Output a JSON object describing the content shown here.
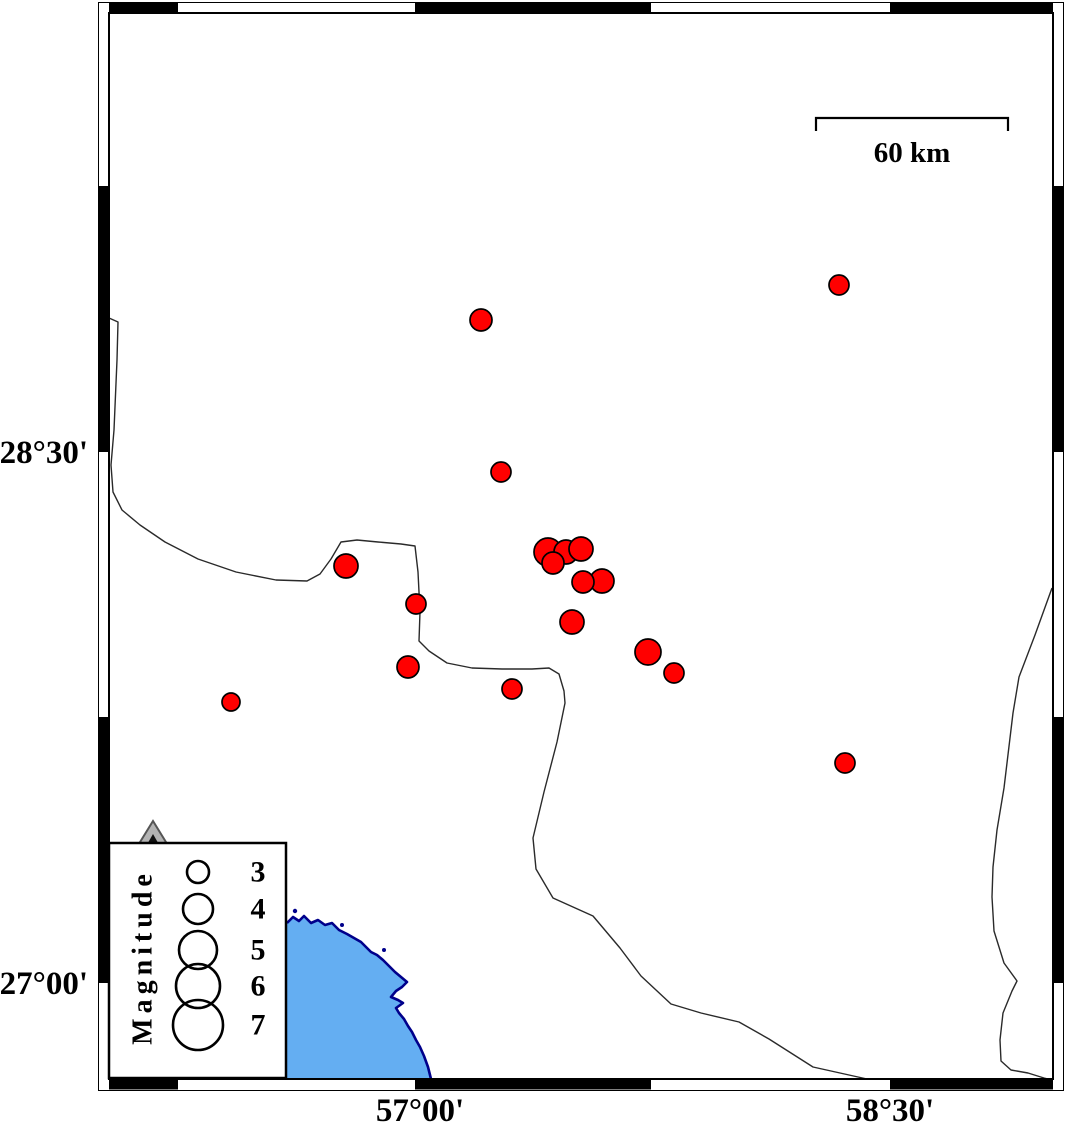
{
  "map": {
    "colors": {
      "epicenter": "#ff0000",
      "epicenter_outline": "#000000",
      "sea": "#64aef2",
      "coastline": "#00008b",
      "boundary": "#2a2a2a",
      "frame": "#000000",
      "land": "#ffffff",
      "legend_triangle": "#b3b3b3"
    },
    "frame": {
      "lat_labels": [
        {
          "text": "28°30'",
          "y": 452
        },
        {
          "text": "27°00'",
          "y": 983
        }
      ],
      "lon_labels": [
        {
          "text": "57°00'",
          "x": 420
        },
        {
          "text": "58°30'",
          "x": 890
        }
      ]
    },
    "scale_bar": {
      "label": "60 km"
    },
    "legend": {
      "title": "Magnitude",
      "entries": [
        {
          "label": "3",
          "r": 11,
          "cy": 872
        },
        {
          "label": "4",
          "r": 15,
          "cy": 909
        },
        {
          "label": "5",
          "r": 19,
          "cy": 950
        },
        {
          "label": "6",
          "r": 22,
          "cy": 986
        },
        {
          "label": "7",
          "r": 25,
          "cy": 1025
        }
      ]
    },
    "earthquakes": [
      {
        "x": 481,
        "y": 320,
        "r": 11
      },
      {
        "x": 839,
        "y": 285,
        "r": 10
      },
      {
        "x": 501,
        "y": 472,
        "r": 10
      },
      {
        "x": 548,
        "y": 552,
        "r": 14
      },
      {
        "x": 566,
        "y": 552,
        "r": 12
      },
      {
        "x": 581,
        "y": 549,
        "r": 12
      },
      {
        "x": 553,
        "y": 563,
        "r": 11
      },
      {
        "x": 602,
        "y": 581,
        "r": 12
      },
      {
        "x": 583,
        "y": 582,
        "r": 11
      },
      {
        "x": 572,
        "y": 622,
        "r": 12
      },
      {
        "x": 346,
        "y": 566,
        "r": 12
      },
      {
        "x": 416,
        "y": 604,
        "r": 10
      },
      {
        "x": 408,
        "y": 667,
        "r": 11
      },
      {
        "x": 648,
        "y": 652,
        "r": 13
      },
      {
        "x": 674,
        "y": 673,
        "r": 10
      },
      {
        "x": 231,
        "y": 702,
        "r": 9
      },
      {
        "x": 512,
        "y": 689,
        "r": 10
      },
      {
        "x": 845,
        "y": 763,
        "r": 10
      }
    ],
    "paths": {
      "boundary_north": "M109,318 L118,322 L117,360 L114,430 L111,465 L113,492 L122,510 L140,525 L165,542 L198,559 L236,572 L276,580 L307,581 L320,574 L331,559 L341,542 L357,540 L378,542 L401,544 L415,546 L418,572 L420,612 L419,641 L429,651 L447,663 L472,668 L502,669 L532,669 L549,668 L559,674 L564,691 L565,703 L557,742 L544,792 L533,838 L536,869 L553,898 L593,916 L620,948 L641,976 L671,1004 L701,1013 L739,1022 L769,1039 L813,1067 L867,1079",
      "boundary_east": "M1052,588 L1035,635 L1019,677 L1013,713 L1004,788 L997,830 L993,867 L992,897 L994,931 L1004,963 L1017,981 L1012,991 L1003,1013 L1000,1040 L1001,1061 L1011,1070 L1028,1073 L1044,1078 L1052,1080",
      "coast_line": "M287,923 L293,917 L299,921 L304,916 L311,923 L318,920 L325,925 L332,923 L339,930 L347,934 L354,938 L361,942 L366,947 L371,952 L377,955 L383,960 L389,966 L395,972 L401,977 L407,982 L402,987 L396,991 L391,997 L398,1000 L403,1003 L396,1008 L399,1013 L404,1019 L408,1026 L412,1032 L416,1040 L420,1047 L424,1056 L428,1067 L431,1079",
      "sea_fill": "M287,923 L293,917 L299,921 L304,916 L311,923 L318,920 L325,925 L332,923 L339,930 L347,934 L354,938 L361,942 L366,947 L371,952 L377,955 L383,960 L389,966 L395,972 L401,977 L407,982 L402,987 L396,991 L391,997 L398,1000 L403,1003 L396,1008 L399,1013 L404,1019 L408,1026 L412,1032 L416,1040 L420,1047 L424,1056 L428,1067 L431,1079 L432,1080 L286,1080 Z"
    }
  }
}
